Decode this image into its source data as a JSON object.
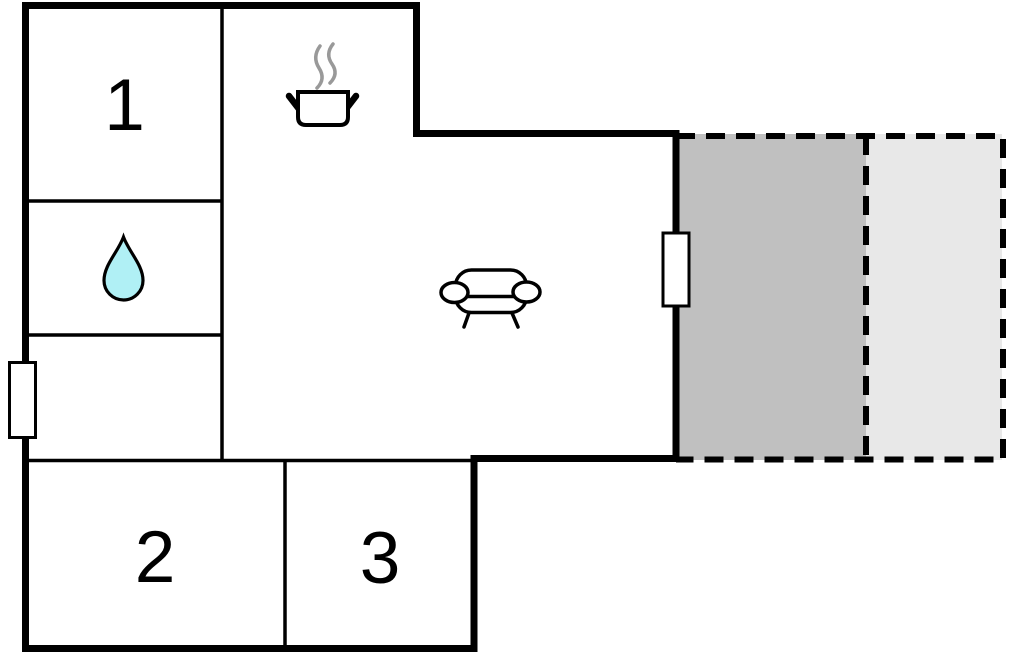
{
  "floorplan": {
    "type": "holiday-home-floor-plan",
    "rooms": [
      {
        "id": "room-1",
        "label": "1",
        "kind": "bedroom"
      },
      {
        "id": "room-2",
        "label": "2",
        "kind": "bedroom"
      },
      {
        "id": "room-3",
        "label": "3",
        "kind": "bedroom"
      }
    ],
    "icons": [
      {
        "name": "cooking-pot-icon",
        "meaning": "kitchen"
      },
      {
        "name": "water-drop-icon",
        "meaning": "bathroom"
      },
      {
        "name": "sofa-icon",
        "meaning": "living-room"
      }
    ],
    "features": [
      {
        "name": "door-left",
        "kind": "door-window-opening"
      },
      {
        "name": "door-right",
        "kind": "door-window-opening"
      },
      {
        "name": "terrace-covered",
        "kind": "covered-terrace"
      },
      {
        "name": "terrace-open",
        "kind": "open-terrace"
      }
    ],
    "colors": {
      "wall": "#000000",
      "background": "#ffffff",
      "water_drop": "#b0f0f5",
      "steam": "#999999",
      "terrace_covered": "#c0c0c0",
      "terrace_open": "#e8e8e8"
    }
  }
}
